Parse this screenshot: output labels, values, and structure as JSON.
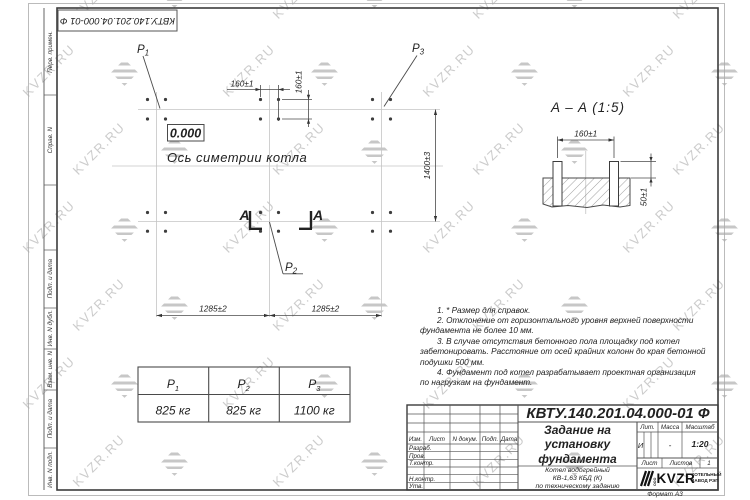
{
  "sheet": {
    "doc_number_rotated": "КВТУ.140.201.04.000-01 Ф",
    "format_label": "Формат А3",
    "margin_labels": [
      "Перв. примен.",
      "Справ. N",
      "Подп. и дата",
      "Инв. N дубл.",
      "Взам. инв. N",
      "Подп. и дата",
      "Инв. N подл."
    ]
  },
  "plan": {
    "elevation_mark": "0.000",
    "symmetry_axis_label": "Ось симетрии котла",
    "section_letter": "A",
    "dim_160_top": "160±1",
    "dim_160_side": "160±1",
    "dim_1400": "1400±3",
    "dim_1285_left": "1285±2",
    "dim_1285_right": "1285±2",
    "loads": [
      {
        "p": "P",
        "sub": "1"
      },
      {
        "p": "P",
        "sub": "2"
      },
      {
        "p": "P",
        "sub": "3"
      }
    ]
  },
  "section_view": {
    "title": "A – A (1:5)",
    "dim_160": "160±1",
    "dim_50": "50±1"
  },
  "notes": {
    "lines": [
      "1. * Размер для справок.",
      "2. Отклонение от горизонтального уровня верхней поверхности",
      "фундамента не более 10 мм.",
      "3. В случае отсутствия бетонного пола площадку под котел",
      "забетонировать. Расстояние от осей крайних колонн до края бетонной",
      "подушки 500 мм.",
      "4. Фундамент под котел разрабатывает проектная организация",
      "по нагрузкам на фундамент."
    ]
  },
  "load_table": {
    "headers": [
      {
        "p": "P",
        "sub": "1"
      },
      {
        "p": "P",
        "sub": "2"
      },
      {
        "p": "P",
        "sub": "3"
      }
    ],
    "values": [
      "825 кг",
      "825 кг",
      "1100 кг"
    ]
  },
  "title_block": {
    "doc_number": "КВТУ.140.201.04.000-01 Ф",
    "title_lines": [
      "Задание на",
      "установку",
      "фундамента"
    ],
    "subtitle_lines": [
      "Котел водогрейный",
      "КВ-1,63 КБД (К)",
      "по техническому заданию"
    ],
    "header_cols": [
      "Изм.",
      "Лист",
      "N докум.",
      "Подп.",
      "Дата"
    ],
    "sign_rows": [
      "Разраб.",
      "Пров.",
      "Т.контр.",
      "",
      "Н.контр.",
      "Утв."
    ],
    "lit_label": "Лит.",
    "lit_value": "И",
    "mass_label": "Масса",
    "mass_value": "-",
    "scale_label": "Масштаб",
    "scale_value": "1:20",
    "sheet_label": "Лист",
    "sheets_label": "Листов",
    "sheets_value": "1",
    "logo": {
      "ooo": "ООО",
      "name": "KVZR",
      "caption_lines": [
        "КОТЕЛЬНЫЙ",
        "ЗАВОД РЭП"
      ]
    }
  },
  "watermark": {
    "text": "KVZR.RU"
  }
}
